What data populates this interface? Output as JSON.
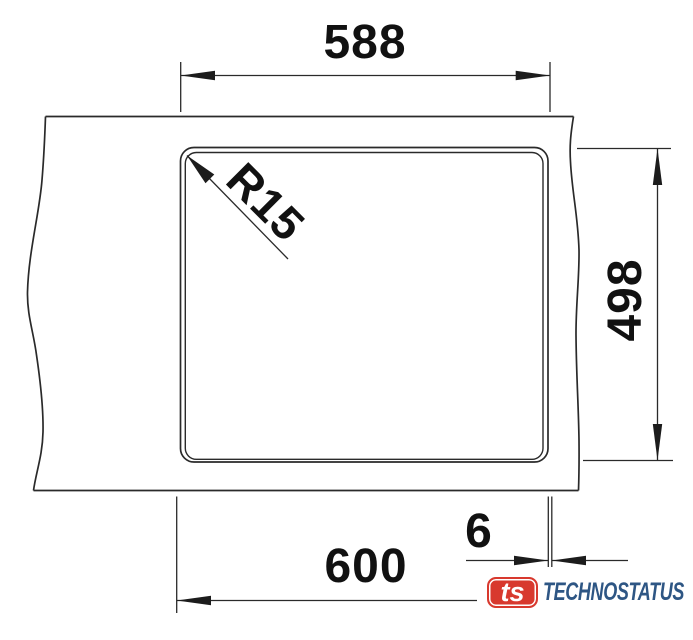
{
  "drawing": {
    "type": "sink cutout installation drawing",
    "dims": {
      "cutout_width": "588",
      "cutout_height": "498",
      "cabinet_width": "600",
      "edge_offset": "6",
      "corner_radius": "R15"
    },
    "logo": {
      "monogram": "ts",
      "brand": "TECHNOSTATUS"
    },
    "colors": {
      "ink": "#2a2a2a",
      "text": "#111111",
      "brand_red": "#d8392e",
      "brand_blue": "#2e5684"
    }
  }
}
